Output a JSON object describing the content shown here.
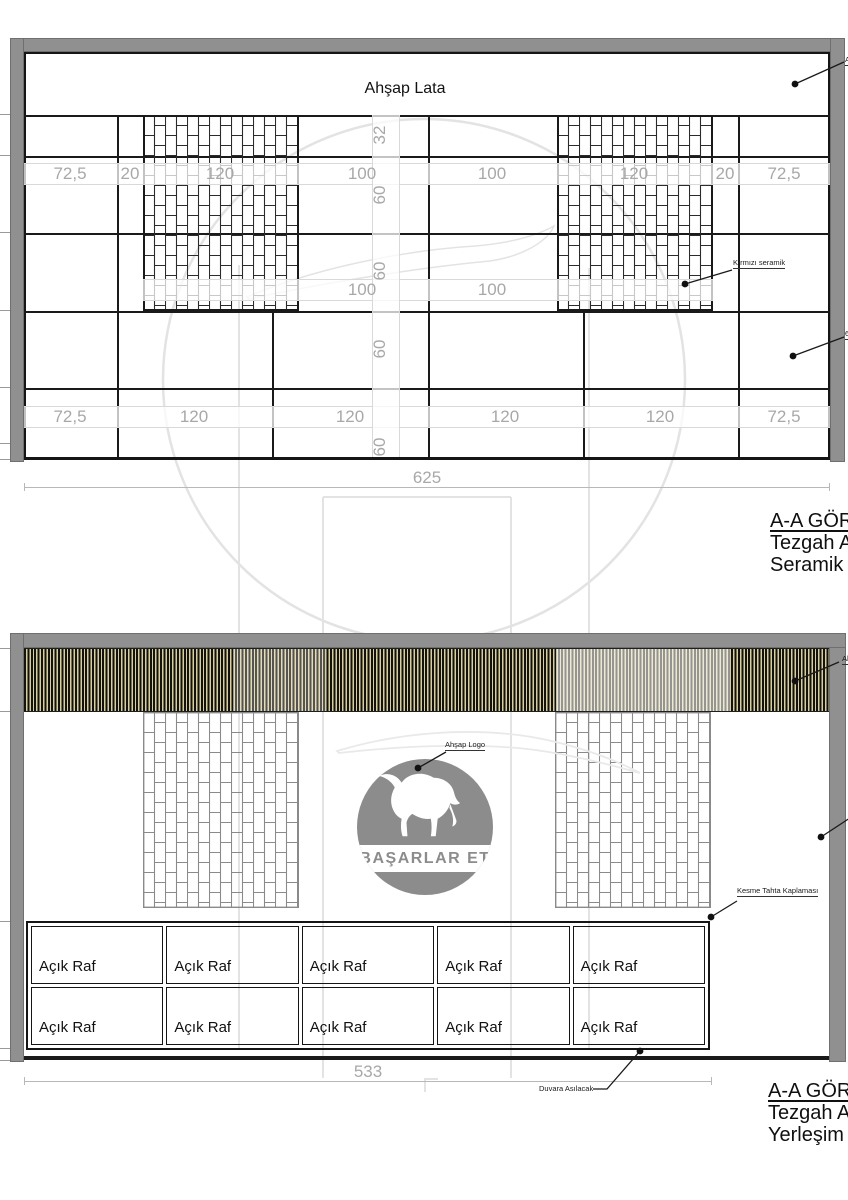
{
  "top_view": {
    "panel_label": "Ahşap Lata",
    "callout_red_ceramic": "Kırmızı seramik",
    "callout_edge_top": "Ahşap Lata",
    "callout_edge_right": "60x60 Seramik",
    "dims_row1": [
      "72,5",
      "20",
      "120",
      "100",
      "100",
      "120",
      "20",
      "72,5"
    ],
    "dims_row2": [
      "100",
      "100"
    ],
    "dims_row3": [
      "72,5",
      "120",
      "120",
      "120",
      "120",
      "72,5"
    ],
    "dims_height": [
      "32",
      "60",
      "60",
      "60",
      "60"
    ],
    "dim_total_width": "625",
    "caption_line1": "A-A GÖRÜNÜŞÜ",
    "caption_line2": "Tezgah Arkası",
    "caption_line3": "Seramik Kaplama"
  },
  "bottom_view": {
    "logo_text": "BAŞARLAR ET",
    "callout_logo": "Ahşap Logo",
    "callout_wood_cladding": "Kesme Tahta Kaplaması",
    "callout_wall_mounted": "Duvara Asılacak",
    "callout_edge_right": "Ahşap Lata",
    "shelf_cells": [
      "Açık Raf",
      "Açık Raf",
      "Açık Raf",
      "Açık Raf",
      "Açık Raf",
      "Açık Raf",
      "Açık Raf",
      "Açık Raf",
      "Açık Raf",
      "Açık Raf"
    ],
    "dim_total_width": "533",
    "caption_line1": "A-A GÖRÜNÜŞÜ",
    "caption_line2": "Tezgah Arkası",
    "caption_line3": "Yerleşim Planı"
  },
  "colors": {
    "wall_gray": "#909090",
    "line_black": "#1a1a1a",
    "dim_gray": "#a8a8a8",
    "slat_tan": "#d8cf9e",
    "slat_dark": "#14120d",
    "brick_outline_dark": "#2b2b2b",
    "brick_outline_light": "#8a8a8a",
    "logo_gray": "#8c8c8c",
    "watermark_gray": "#e3e3e3"
  }
}
